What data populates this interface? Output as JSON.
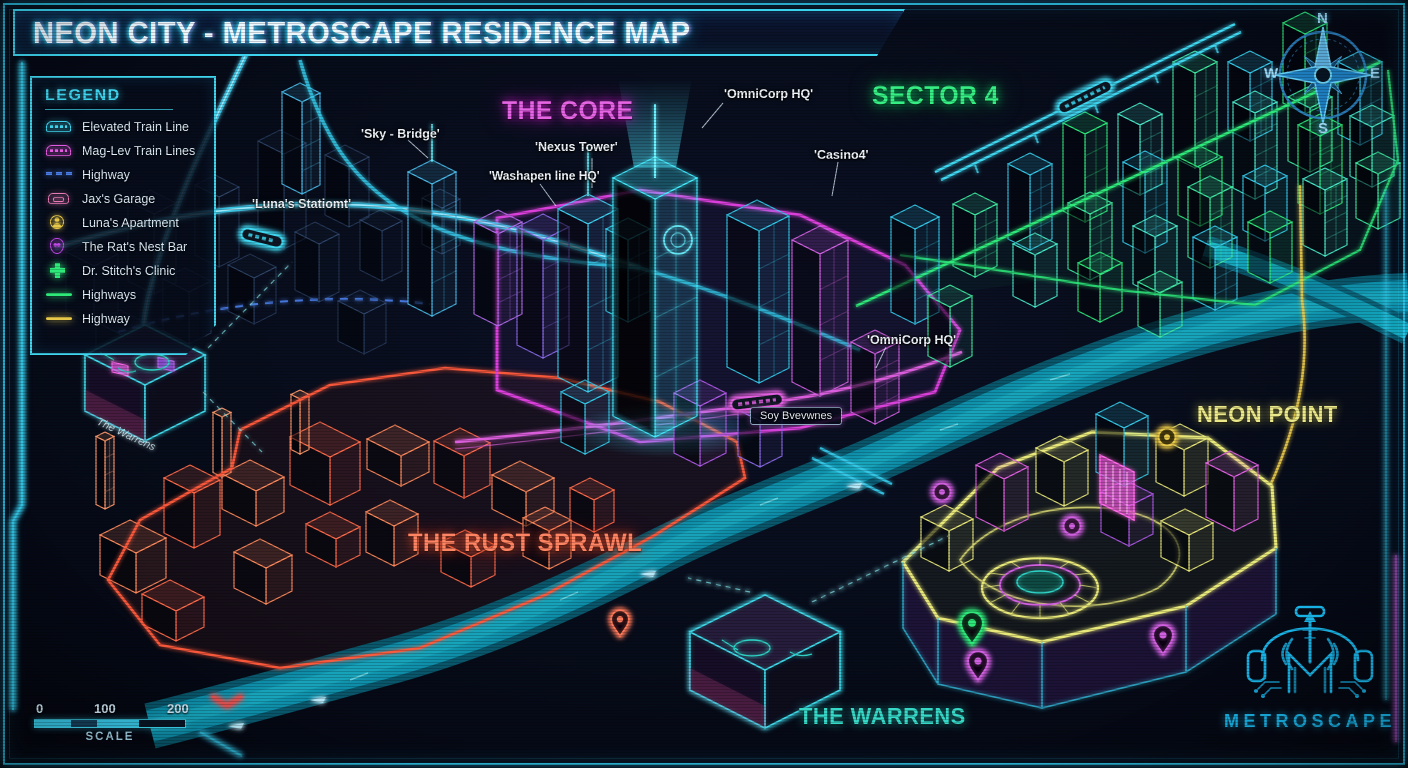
{
  "title": "NEON CITY - METROSCAPE RESIDENCE MAP",
  "legend": {
    "header": "LEGEND",
    "items": [
      {
        "icon": "elevated-train-icon",
        "label": "Elevated Train Line",
        "color": "#3fd6f0"
      },
      {
        "icon": "maglev-train-icon",
        "label": "Mag-Lev Train Lines",
        "color": "#e25ae0"
      },
      {
        "icon": "dashed-highway-icon",
        "label": "Highway",
        "color": "#4a7de8"
      },
      {
        "icon": "car-icon",
        "label": "Jax's Garage",
        "color": "#e87ab8"
      },
      {
        "icon": "person-badge-icon",
        "label": "Luna's Apartment",
        "color": "#e8c84a"
      },
      {
        "icon": "skull-badge-icon",
        "label": "The Rat's Nest Bar",
        "color": "#c04ae8"
      },
      {
        "icon": "medical-cross-icon",
        "label": "Dr. Stitch's Clinic",
        "color": "#2ee87a"
      },
      {
        "icon": "solid-line-icon",
        "label": "Highways",
        "color": "#2ee87a"
      },
      {
        "icon": "solid-line-icon",
        "label": "Highway",
        "color": "#e8c84a"
      }
    ]
  },
  "districts": [
    {
      "name": "THE CORE",
      "color": "#e040e0"
    },
    {
      "name": "SECTOR 4",
      "color": "#2ee87a"
    },
    {
      "name": "NEON POINT",
      "color": "#e8e87a"
    },
    {
      "name": "THE RUST SPRAWL",
      "color": "#ff5a3c"
    },
    {
      "name": "THE WARRENS",
      "color": "#2fd1c4"
    }
  ],
  "poi_labels": [
    {
      "text": "'OmniCorp HQ'"
    },
    {
      "text": "'Nexus Tower'"
    },
    {
      "text": "'Washapen line HQ'"
    },
    {
      "text": "'Sky - Bridge'"
    },
    {
      "text": "'Casino4'"
    },
    {
      "text": "'Luna's Statiomt'"
    },
    {
      "text": "'OmniCorp HQ'"
    },
    {
      "text": "Soy Bvevwnes"
    },
    {
      "text": "The Warrens"
    }
  ],
  "compass": {
    "n": "N",
    "e": "E",
    "s": "S",
    "w": "W"
  },
  "scale": {
    "ticks": [
      "0",
      "100",
      "200"
    ],
    "label": "SCALE"
  },
  "logo": {
    "text": "METROSCAPE"
  }
}
